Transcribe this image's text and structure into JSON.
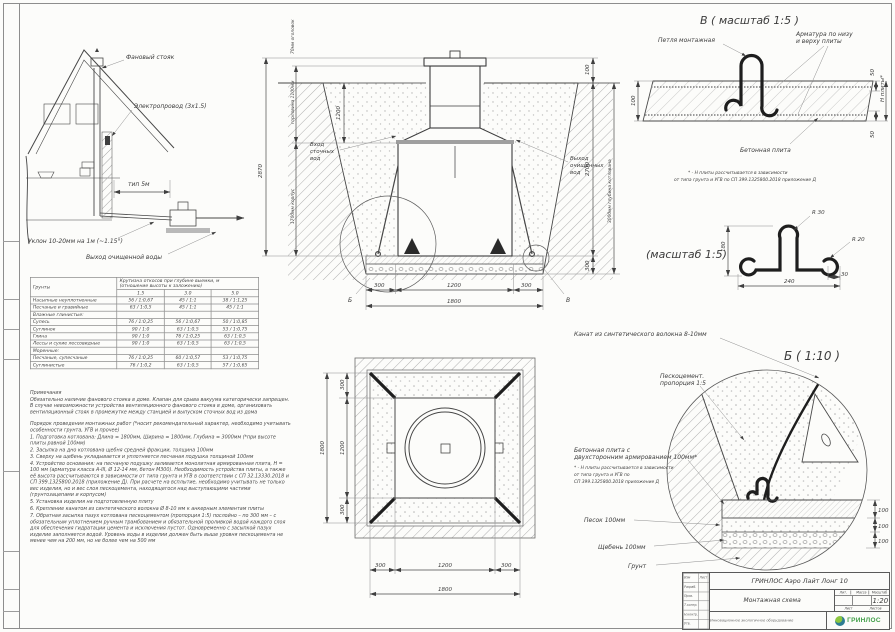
{
  "colors": {
    "line": "#3c3c3c",
    "logo_green": "#3f9e46",
    "logo_teal": "#2e7d93"
  },
  "house": {
    "label_stack": "Фановый стояк",
    "label_cable": "Электропровод (3х1.5)",
    "label_span": "тип 5м",
    "label_slope": "Уклон 10-20мм на 1м (~1.15°)",
    "label_outlet": "Выход очищенной воды"
  },
  "section": {
    "dim_total": "2870",
    "dim_head": "70мм оголовок",
    "dim_neck": "горловина 1100мм",
    "dim_body": "1700мм корпус",
    "dim_1200": "1200",
    "dim_100": "100",
    "dim_2700": "2700",
    "dim_300": "300",
    "dim_pit": "3000мм глубина котлована",
    "inlet1": "Вход",
    "inlet2": "сточных",
    "inlet3": "вод",
    "outlet1": "Выход",
    "outlet2": "очищенных",
    "outlet3": "вод",
    "b300a": "300",
    "b1200": "1200",
    "b300b": "300",
    "b1800": "1800",
    "callout_b": "Б",
    "callout_v": "В"
  },
  "detail_v": {
    "title": "В ( масштаб 1:5 )",
    "label_loop": "Петля монтажная",
    "label_rebar1": "Арматура по низу",
    "label_rebar2": "и верху плиты",
    "label_slab": "Бетонная плита",
    "dim_100": "100",
    "dim_50top": "50",
    "dim_50bot": "50",
    "dim_h": "Н плиты*",
    "note1": "* - Н плиты рассчитывается в зависимости",
    "note2": "от типа грунта и УГВ по СП 399.1325800.2018 приложение Д"
  },
  "hook": {
    "title": "(масштаб 1:5)",
    "r30": "R 30",
    "r20": "R 20",
    "dim_h": "180",
    "dim_w": "240",
    "dim_30": "30"
  },
  "detail_b": {
    "title": "Б ( 1:10 )",
    "label_rope": "Канат из синтетического волокна 8-10мм",
    "label_sc1": "Пескоцемент.",
    "label_sc2": "пропорция 1:5",
    "label_slab1": "Бетонная плита с",
    "label_slab2": "двухсторонним армированием 100мм*",
    "note1": "* - Н плиты рассчитывается в зависимости",
    "note2": "от типа грунта и УГВ по",
    "note3": "СП 399.1325800.2018 приложение Д",
    "label_sand": "Песок 100мм",
    "label_gravel": "Щебень 100мм",
    "label_soil": "Грунт",
    "dim1": "100",
    "dim2": "100",
    "dim3": "100"
  },
  "plan": {
    "dim_left_total": "1800",
    "d300a": "300",
    "d1200": "1200",
    "d300b": "300",
    "dim_bottom_total": "1800"
  },
  "soil": {
    "col_soil": "Грунты",
    "col_slope1": "Крутизна откосов при глубине выемки, м",
    "col_slope2": "(отношение высоты к заложению)",
    "depths": [
      "1.5",
      "3.0",
      "5.0"
    ],
    "rows": [
      {
        "name": "Насыпные неуплотненные",
        "v1": "56 / 1:0,67",
        "v2": "45 / 1:1",
        "v3": "38 / 1:1,25"
      },
      {
        "name": "Песчаные и гравийные",
        "v1": "63 / 1:0,5",
        "v2": "45 / 1:1",
        "v3": "45 / 1:1"
      },
      {
        "name": "Влажные глинистые:",
        "v1": "",
        "v2": "",
        "v3": ""
      },
      {
        "name": "Супесь",
        "v1": "76 / 1:0,25",
        "v2": "56 / 1:0,67",
        "v3": "50 / 1:0,85"
      },
      {
        "name": "Суглинок",
        "v1": "90 / 1:0",
        "v2": "63 / 1:0,5",
        "v3": "53 / 1:0,75"
      },
      {
        "name": "Глина",
        "v1": "90 / 1:0",
        "v2": "76 / 1:0,25",
        "v3": "63 / 1:0,5"
      },
      {
        "name": "Лессы и сухие лессовидные",
        "v1": "90 / 1:0",
        "v2": "63 / 1:0,5",
        "v3": "63 / 1:0,5"
      },
      {
        "name": "Моренные:",
        "v1": "",
        "v2": "",
        "v3": ""
      },
      {
        "name": "Песчаные, супесчаные",
        "v1": "76 / 1:0,25",
        "v2": "60 / 1:0,57",
        "v3": "53 / 1:0,75"
      },
      {
        "name": "Суглинистые",
        "v1": "76 / 1:0,2",
        "v2": "63 / 1:0,5",
        "v3": "57 / 1:0,65"
      }
    ]
  },
  "notes": {
    "h1": "Примечания",
    "p1": "Обязательно наличие фанового стояка в доме. Клапан для срыва вакуума категорически запрещен. В случае невозможности устройства вентиляционного фанового стояка в доме, организовать вентиляционный стояк в промежутке между станцией и выпуском сточных вод из дома",
    "h2": "Порядок проведения монтажных работ (*носит рекомендательный характер, необходимо учитывать особенности грунта, УГВ и прочее)",
    "items": [
      "1. Подготовка котлована: Длина = 1800мм,  Ширина = 1800мм, Глубина = 3000мм (*при высоте плиты равной 100мм)",
      "2. Засыпка на дно котлована щебня средней фракции, толщина 100мм",
      "3. Сверху на щебень укладывается и уплотняется песчаная подушка толщиной 100мм",
      "4. Устройство основания: на песчаную подушку заливается монолитная армированная плита, Н = 100 мм (арматура класса А-III, Ø 12-14 мм, бетон М300). Необходимость устройства плиты, а также её высота рассчитываются в зависимости от типа грунта и УГВ в соответствии с СП 32.13330.2018 и СП 399.1325800.2018 (приложение Д). При расчете на всплытие, необходимо учитывать не только вес изделия, но и вес слоя пескоцемента, находящегося над выступающими частями (грунтозацепами и корпусом)",
      "5. Установка изделия на подготовленную плиту",
      "6. Крепление канатом из синтетического волокна Ø 8-10 мм к анкерным элементам плиты",
      "7. Обратная засыпка пазух котлована пескоцементом (пропорция 1:5) послойно – по 300 мм – с обязательным уплотнением ручным трамбованием и обязательной проливкой водой каждого слоя для обеспечения гидратации цемента и исключения пустот. Одновременно с засыпкой пазух изделие заполняется водой. Уровень воды в изделии должен быть выше уровня пескоцемента не менее чем на 200 мм, но не более чем на 500 мм"
    ]
  },
  "titleblock": {
    "product": "ГРИНЛОС Аэро Лайт Лонг 10",
    "doc": "Монтажная схема",
    "scale_value": "1:20",
    "lit": "Лит.",
    "mass": "Масса",
    "scale": "Масштаб",
    "sheet": "Лист",
    "sheets": "Листов",
    "tagline": "Инновационное экологичное оборудование",
    "logo": "ГРИНЛОС",
    "sig_cols": [
      "Изм",
      "Лист",
      "№ докум.",
      "Подп.",
      "Дата"
    ],
    "sig_rows": [
      "Разраб.",
      "Пров.",
      "Т.контр.",
      "Н.контр.",
      "Утв."
    ]
  }
}
